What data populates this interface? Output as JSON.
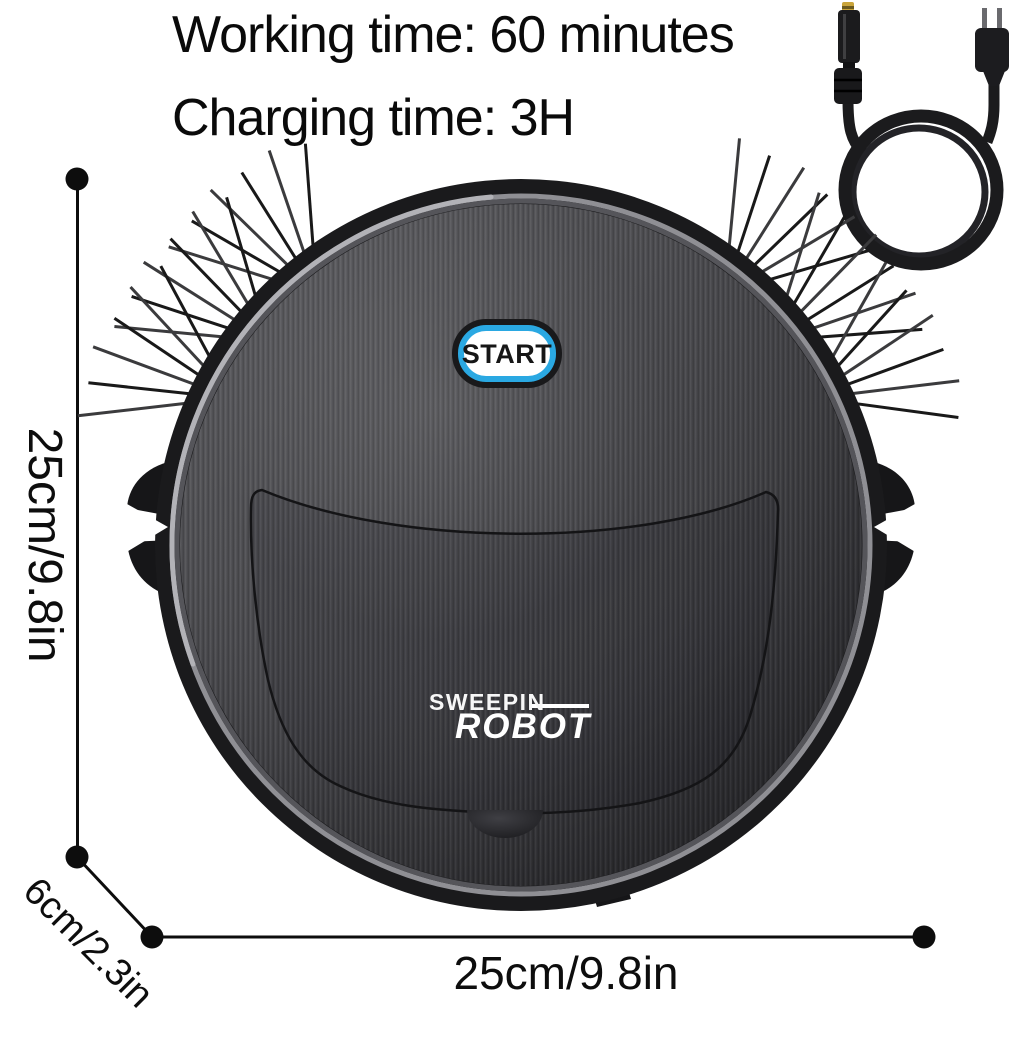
{
  "header": {
    "working_time": "Working time: 60 minutes",
    "charging_time": "Charging time: 3H"
  },
  "product": {
    "start_button_label": "START",
    "brand_top": "SWEEPIN",
    "brand_bottom": "ROBOT"
  },
  "dimensions": {
    "left_label": "25cm/9.8in",
    "bottom_label": "25cm/9.8in",
    "diagonal_label": "6cm/2.3in"
  },
  "colors": {
    "start_button_ring": "#2aa8e2",
    "body_dark": "#1a1a1c",
    "surface_gray": "#47474b",
    "dc_tip_gold": "#c9a43a",
    "annotation": "#0d0d0d",
    "background": "#ffffff"
  }
}
